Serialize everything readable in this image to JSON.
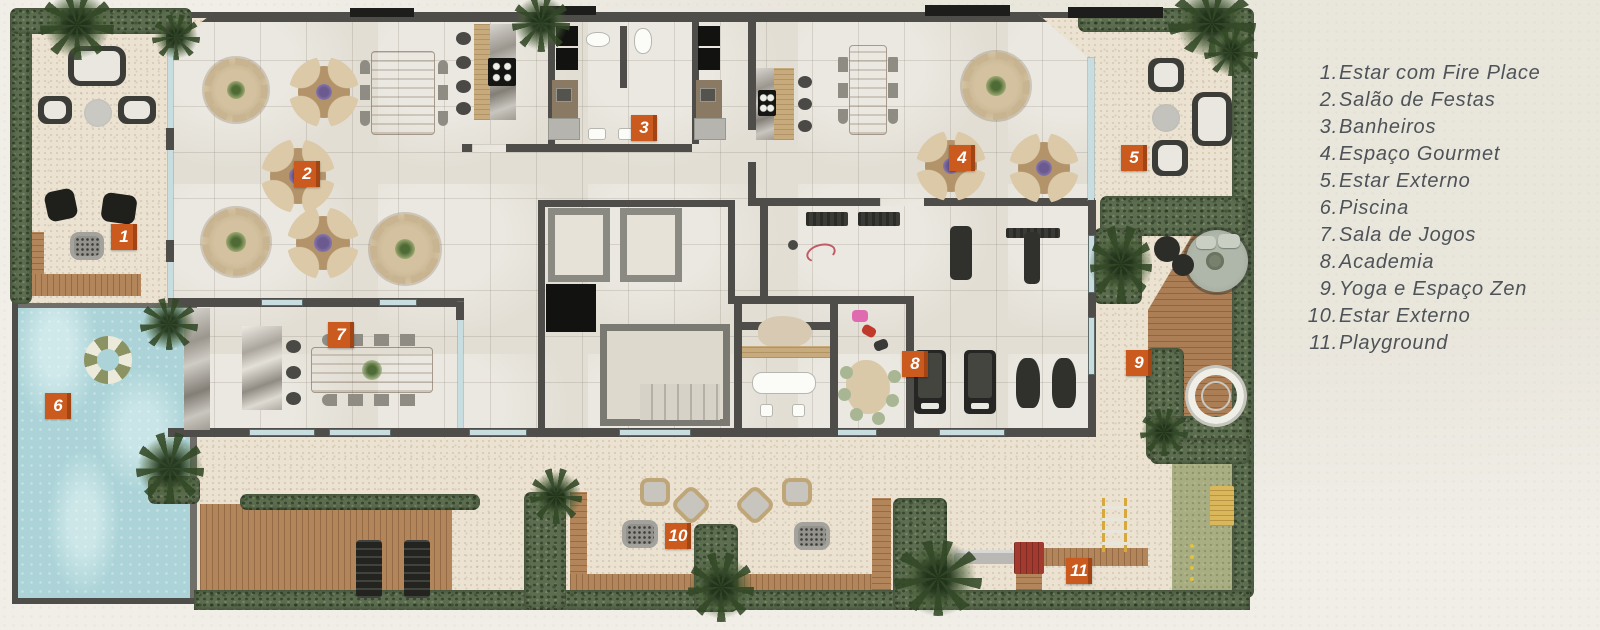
{
  "legend": {
    "items": [
      {
        "num": "1.",
        "label": "Estar com Fire Place"
      },
      {
        "num": "2.",
        "label": "Salão de Festas"
      },
      {
        "num": "3.",
        "label": "Banheiros"
      },
      {
        "num": "4.",
        "label": "Espaço Gourmet"
      },
      {
        "num": "5.",
        "label": "Estar Externo"
      },
      {
        "num": "6.",
        "label": "Piscina"
      },
      {
        "num": "7.",
        "label": "Sala de Jogos"
      },
      {
        "num": "8.",
        "label": "Academia"
      },
      {
        "num": "9.",
        "label": "Yoga e Espaço Zen"
      },
      {
        "num": "10.",
        "label": "Estar Externo"
      },
      {
        "num": "11.",
        "label": "Playground"
      }
    ]
  },
  "markers": [
    {
      "number": "1",
      "room": "Estar com Fire Place"
    },
    {
      "number": "2",
      "room": "Salão de Festas"
    },
    {
      "number": "3",
      "room": "Banheiros"
    },
    {
      "number": "4",
      "room": "Espaço Gourmet"
    },
    {
      "number": "5",
      "room": "Estar Externo"
    },
    {
      "number": "6",
      "room": "Piscina"
    },
    {
      "number": "7",
      "room": "Sala de Jogos"
    },
    {
      "number": "8",
      "room": "Academia"
    },
    {
      "number": "9",
      "room": "Yoga e Espaço Zen"
    },
    {
      "number": "10",
      "room": "Estar Externo"
    },
    {
      "number": "11",
      "room": "Playground"
    }
  ],
  "colors": {
    "marker_orange": "#cb5a1f",
    "pool_water": "#acd4d8",
    "lawn_green": "#a8ad82",
    "hedge_green": "#5d6d50",
    "deck_wood": "#b2855a",
    "wall_dark": "#4e4d49",
    "legend_text": "#4e5358",
    "paper_background": "#f0eee7"
  }
}
